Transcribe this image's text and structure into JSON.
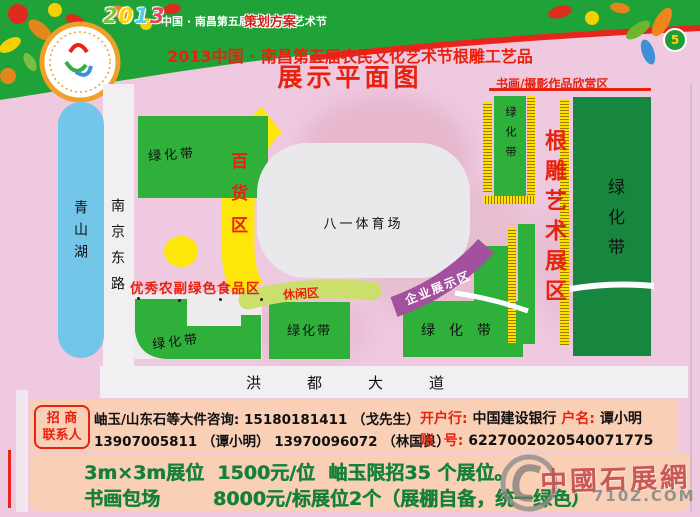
{
  "banner": {
    "year_chars": [
      "2",
      "0",
      "1",
      "3"
    ],
    "festival_name": "中国 · 南昌第五届农民文化艺术节",
    "plan_label": "策划方案",
    "page_number": "5"
  },
  "title": {
    "line1": "2013中国 · 南昌第五届农民文化艺术节根雕工艺品",
    "line2": "展示平面图"
  },
  "map": {
    "lake": "青山湖",
    "road_west": "南京东路",
    "road_south": "洪都大道",
    "stadium": "八一体育场",
    "green_belt": "绿化带",
    "department_zone": "百货区",
    "food_zone": "优秀农副绿色食品区",
    "leisure_zone": "休闲区",
    "enterprise_zone": "企业展示区",
    "root_carving_zone": "根雕艺术展区",
    "art_zone": "书画/摄影作品欣赏区"
  },
  "contact": {
    "box_line1": "招 商",
    "box_line2": "联系人",
    "line1": "岫玉/山东石等大件咨询: 15180181411 （戈先生）",
    "line2": "13907005811 （谭小明）  13970096072 （林国良）",
    "bank_label": "开户行:",
    "bank_value": "中国建设银行",
    "account_name_label": "户名:",
    "account_name": "谭小明",
    "account_no_label": "账  号:",
    "account_no": "6227002020540071775"
  },
  "pricing": {
    "line1": "3m×3m展位  1500元/位  岫玉限招35 个展位。",
    "line2": "书画包场        8000元/标展位2个（展棚自备，统一绿色）"
  },
  "watermark": {
    "name": "中國石展網",
    "url": "710Z.COM"
  },
  "colors": {
    "banner_green": "#1fa238",
    "title_red": "#e8220f",
    "map_green": "#2fb03a",
    "dark_green": "#17873f",
    "band_yellow": "#ffe60a",
    "purple": "#a3509f",
    "lake_blue": "#74c6e9",
    "panel_salmon": "#f9cfb6",
    "price_green": "#15803a"
  }
}
